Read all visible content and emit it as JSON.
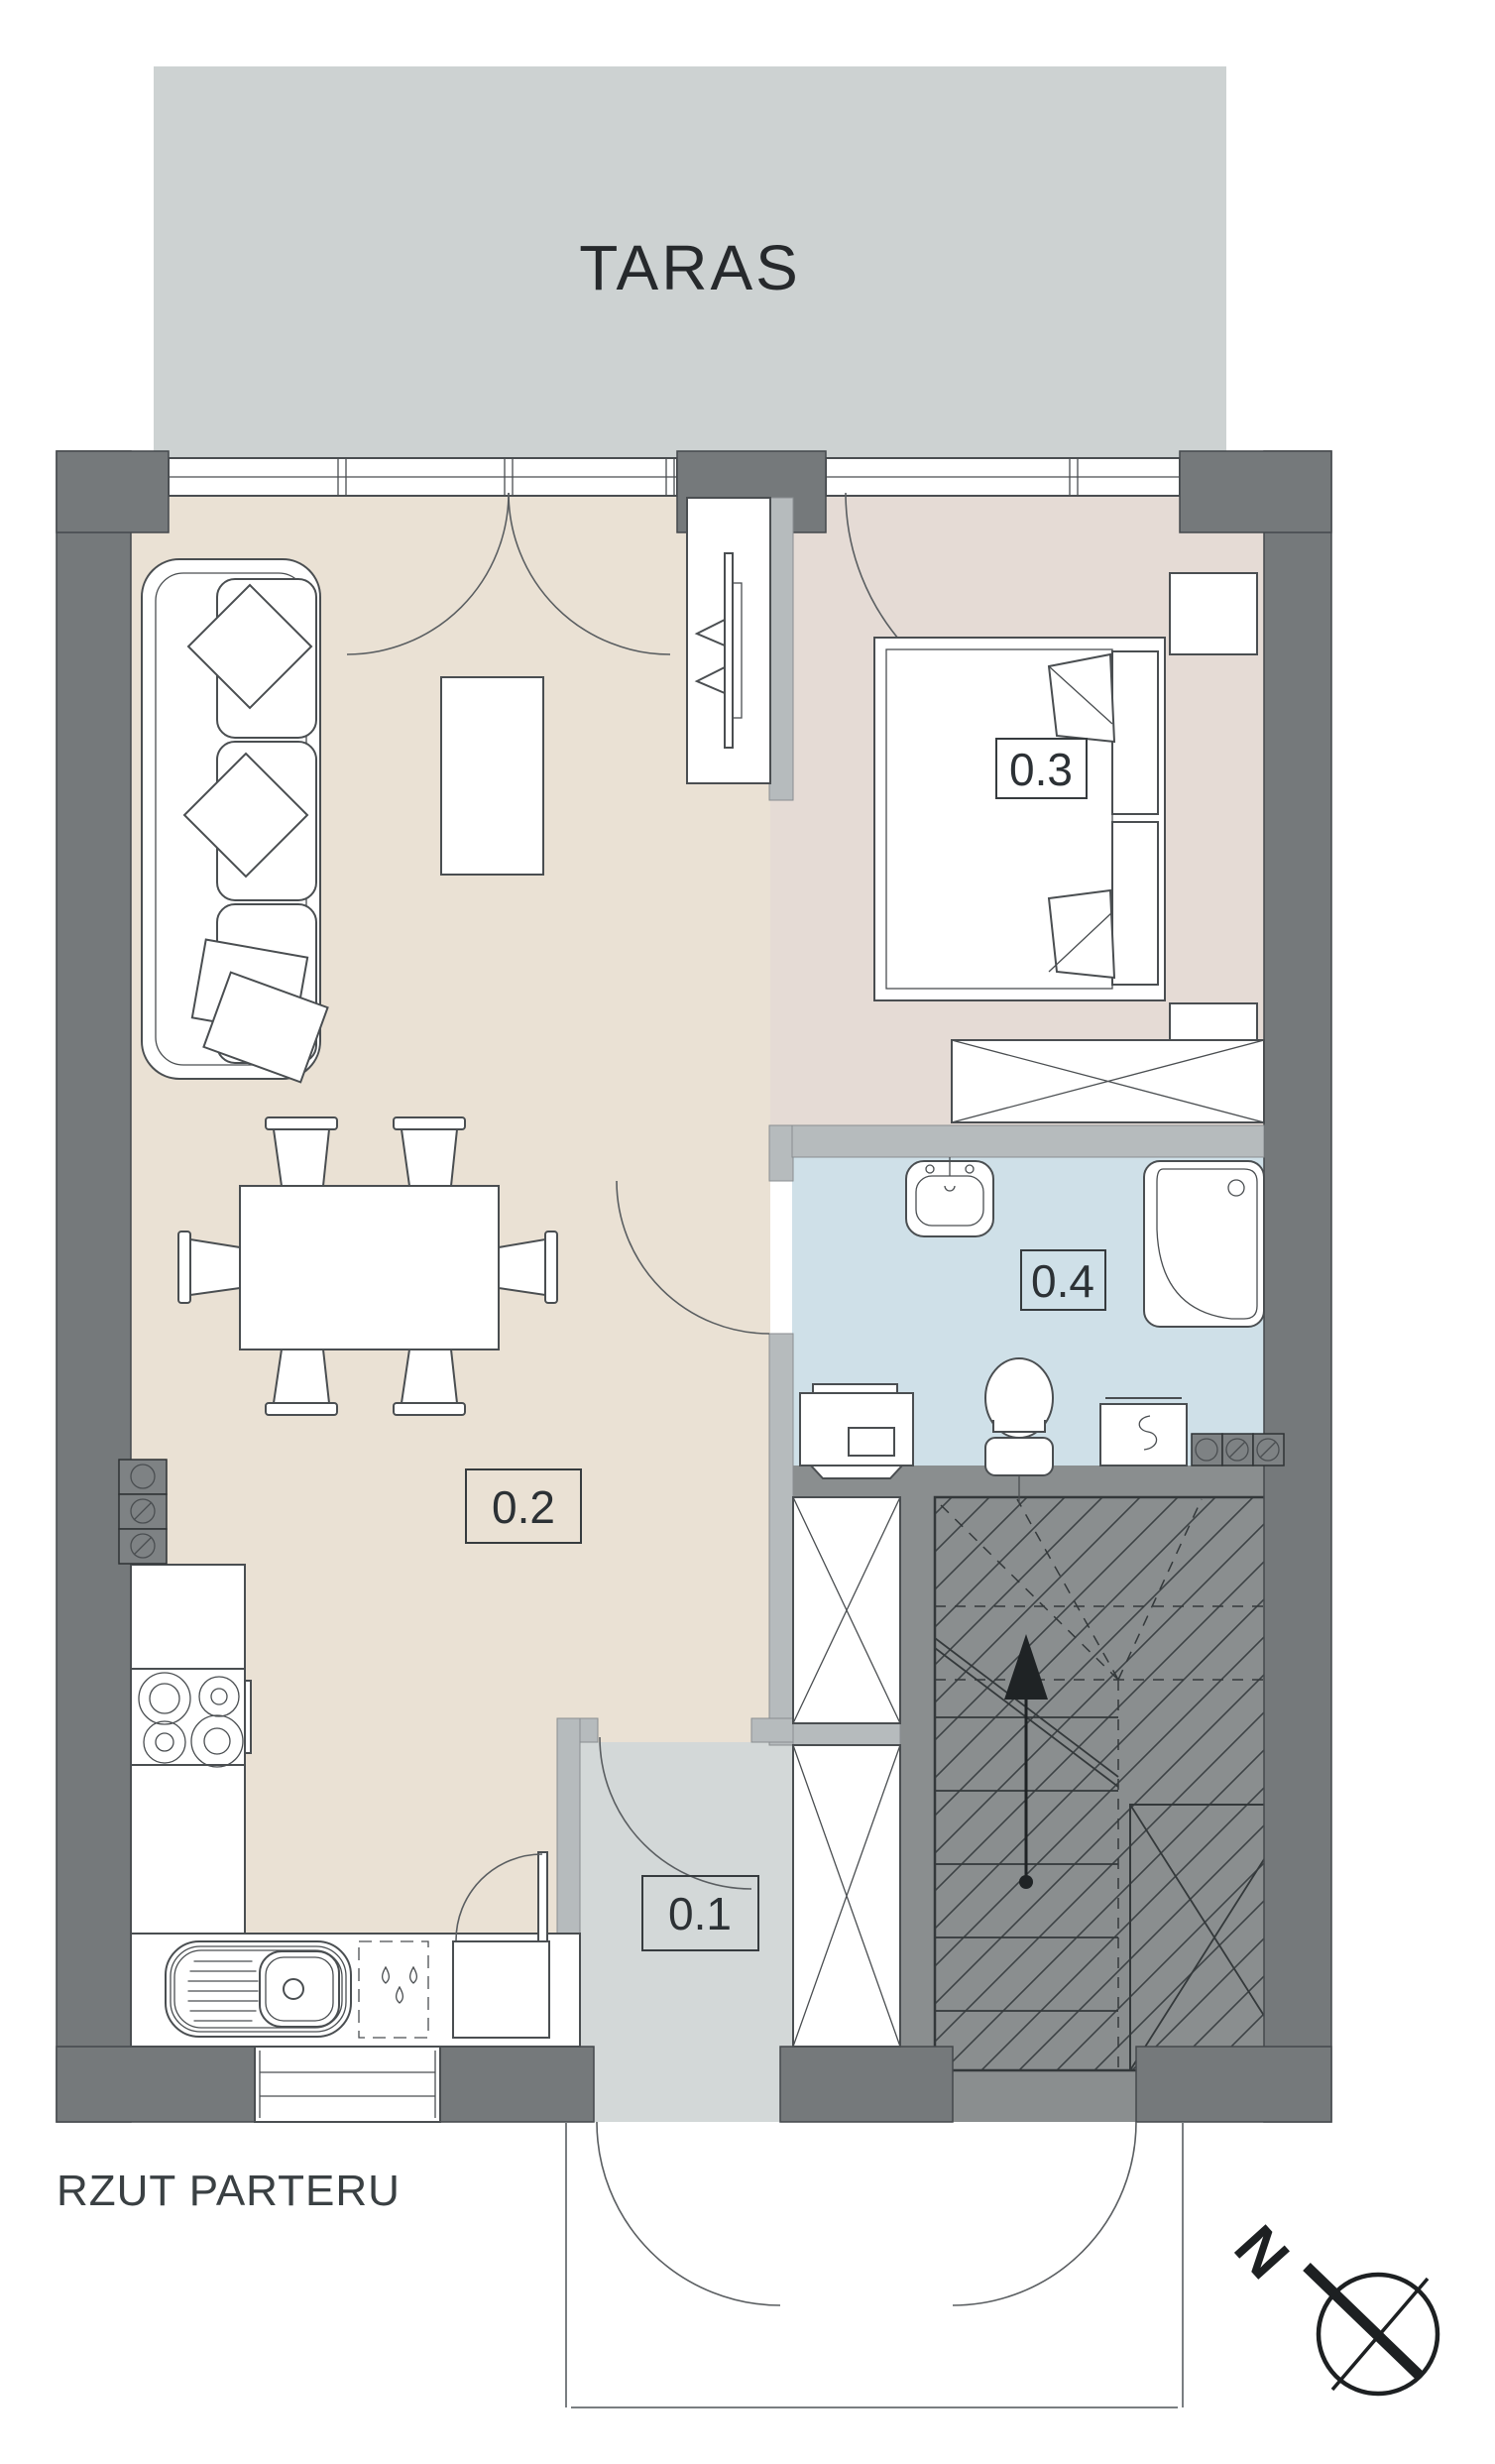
{
  "title": "RZUT PARTERU",
  "terrace": {
    "label": "TARAS"
  },
  "rooms": [
    {
      "label": "0.1"
    },
    {
      "label": "0.2"
    },
    {
      "label": "0.3"
    },
    {
      "label": "0.4"
    }
  ],
  "compass": {
    "north_label": "N"
  },
  "colors": {
    "terrace": "#cdd2d2",
    "wall-dark": "#75797b",
    "wall-light": "#b6bbbd",
    "floor-living": "#eae1d4",
    "floor-bedroom": "#e5dbd5",
    "floor-bath": "#cfe0e8",
    "floor-hall": "#d3d8d8",
    "stairs": "#8a8e8f",
    "line": "#4a4e51"
  }
}
